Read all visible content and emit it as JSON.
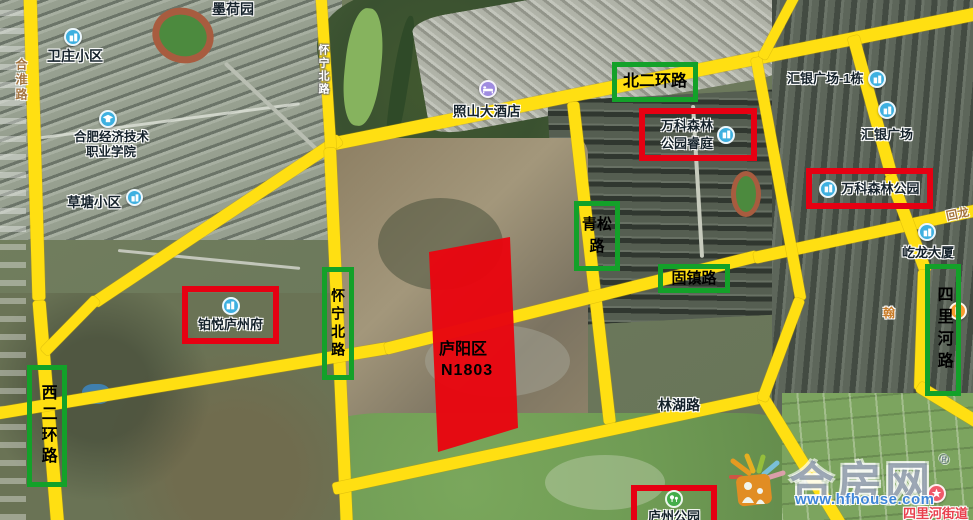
{
  "parcel": {
    "district": "庐阳区",
    "code": "N1803"
  },
  "green_boxes": [
    {
      "id": "beierhuan-road",
      "text": "北二环路"
    },
    {
      "id": "qingsong-road",
      "text": "青松路"
    },
    {
      "id": "guzhen-road",
      "text": "固镇路"
    },
    {
      "id": "silihe-road",
      "text": "四里河路"
    },
    {
      "id": "xierhuan-road",
      "text": "西二环路"
    },
    {
      "id": "huaining-north-road",
      "text": "怀宁北路"
    }
  ],
  "red_boxes": [
    {
      "id": "vanke-forest-ruiting",
      "line1": "万科森林",
      "line2": "公园睿庭"
    },
    {
      "id": "vanke-forest-park",
      "text": "万科森林公园"
    },
    {
      "id": "boyue-luzhoufu",
      "text": "铂悦庐州府"
    },
    {
      "id": "luzhou-park",
      "text": "庐州公园"
    }
  ],
  "pois": [
    {
      "id": "moheyuan",
      "text": "墨荷园"
    },
    {
      "id": "weizhuang",
      "text": "卫庄小区"
    },
    {
      "id": "hefei-college",
      "line1": "合肥经济技术",
      "line2": "职业学院"
    },
    {
      "id": "caotang",
      "text": "草塘小区"
    },
    {
      "id": "zhaoshan-hotel",
      "text": "照山大酒店"
    },
    {
      "id": "huiyin-tower",
      "text": "汇银广场-1栋"
    },
    {
      "id": "huiyin-plaza",
      "text": "汇银广场"
    },
    {
      "id": "yilong-tower",
      "text": "屹龙大厦"
    },
    {
      "id": "han-partial",
      "text": "翰"
    },
    {
      "id": "silihe-street",
      "text": "四里河街道"
    },
    {
      "id": "linhu-road",
      "text": "林湖路"
    }
  ],
  "road_names": [
    {
      "id": "hehuai-road",
      "text": "合淮路"
    },
    {
      "id": "huaining-on-road",
      "text": "怀宁北路"
    },
    {
      "id": "huilong-partial",
      "text": "回龙"
    }
  ],
  "watermark": {
    "brand": "合房网",
    "reg": "®",
    "url": "www.hfhouse.com"
  },
  "colors": {
    "road_yellow": "#ffdf12",
    "highlight_green": "#13a129",
    "highlight_red": "#e60012",
    "parcel_red": "#e8060f",
    "poi_blue": "#3eb0e0",
    "poi_purple": "#9f8ce0",
    "poi_green": "#43ad4a",
    "poi_red": "#f0596a",
    "poi_orange": "#f89b2e"
  }
}
